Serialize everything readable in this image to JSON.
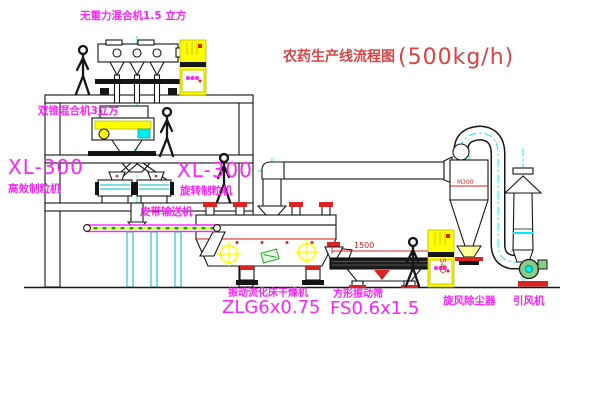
{
  "diagram": {
    "title": {
      "name": "农药生产线流程图",
      "capacity": "(500kg/h)"
    },
    "equipment_labels": {
      "gravity_mixer": "无重力混合机1.5 立方",
      "cone_mixer": "双锥混合机3立方",
      "granulator_left": {
        "model": "XL-300",
        "name": "高效制粒机"
      },
      "granulator_right": {
        "model": "XL-300",
        "name": "旋转制粒机"
      },
      "belt_conveyor": "皮带输送机",
      "fluid_bed_dryer": {
        "name": "振动流化床干燥机",
        "model": "ZLG6x0.75"
      },
      "square_sifter": {
        "name": "方形振动筛",
        "model": "FS0.6x1.5"
      },
      "cyclone": "旋风除尘器",
      "induced_draft_fan": "引风机"
    },
    "dimensions": {
      "sifter_length": "1500",
      "sifter_height": "540",
      "cyclone_mark": "M300"
    },
    "colors": {
      "label": "#ff22ff",
      "titleRed": "#d84444",
      "red": "#dd2222",
      "yellow": "#ffff00",
      "cyan": "#00eeee",
      "green": "#22aa22",
      "line": "#151515",
      "bg": "#ffffff"
    }
  }
}
